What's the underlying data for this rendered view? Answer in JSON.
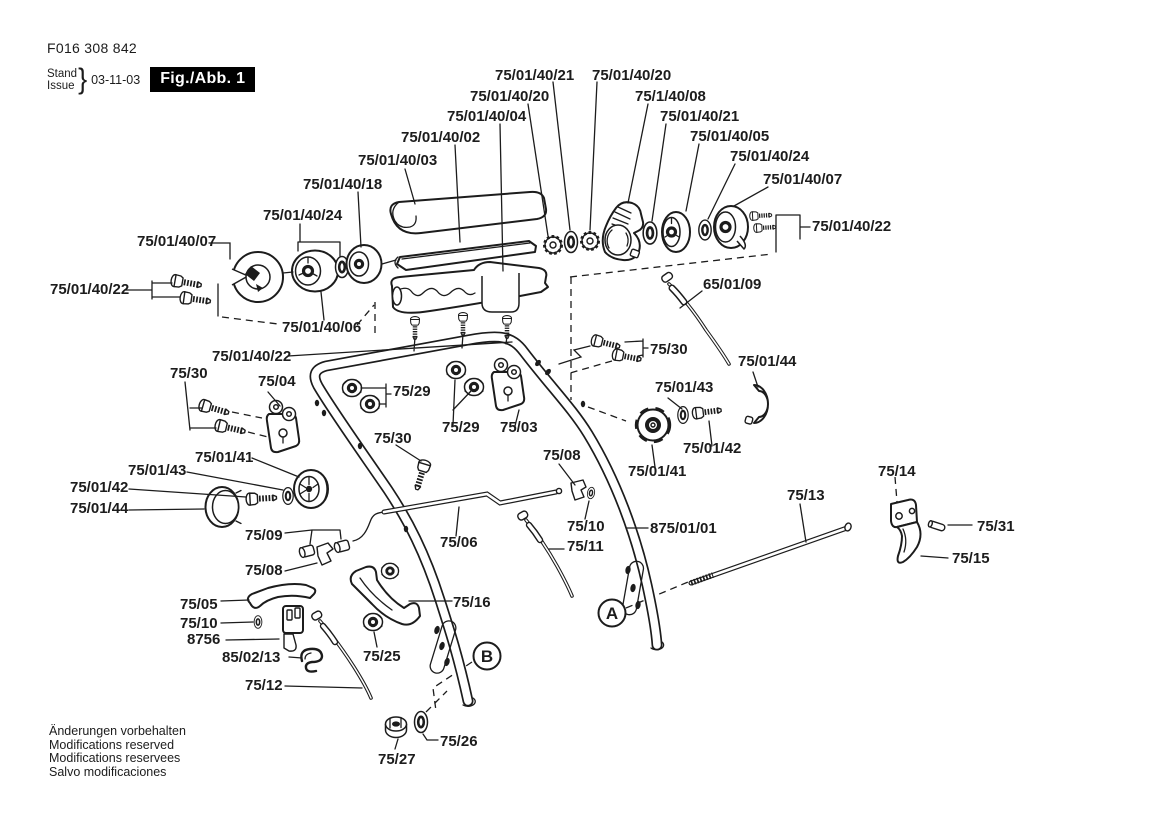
{
  "header": {
    "doc_number": "F016 308 842",
    "stand_label": "Stand",
    "issue_label": "Issue",
    "date": "03-11-03",
    "figure_label": "Fig./Abb. 1"
  },
  "footer": {
    "lines": [
      "Änderungen vorbehalten",
      "Modifications reserved",
      "Modifications reservees",
      "Salvo modificaciones"
    ]
  },
  "colors": {
    "ink": "#1c1c1c",
    "paper": "#ffffff"
  },
  "part_labels": [
    {
      "text": "75/01/40/21",
      "x": 495,
      "y": 80
    },
    {
      "text": "75/01/40/20",
      "x": 592,
      "y": 80
    },
    {
      "text": "75/01/40/20",
      "x": 470,
      "y": 101
    },
    {
      "text": "75/1/40/08",
      "x": 635,
      "y": 101
    },
    {
      "text": "75/01/40/04",
      "x": 447,
      "y": 121
    },
    {
      "text": "75/01/40/21",
      "x": 660,
      "y": 121
    },
    {
      "text": "75/01/40/02",
      "x": 401,
      "y": 142
    },
    {
      "text": "75/01/40/05",
      "x": 690,
      "y": 141
    },
    {
      "text": "75/01/40/03",
      "x": 358,
      "y": 165
    },
    {
      "text": "75/01/40/24",
      "x": 730,
      "y": 161
    },
    {
      "text": "75/01/40/18",
      "x": 303,
      "y": 189
    },
    {
      "text": "75/01/40/07",
      "x": 763,
      "y": 184
    },
    {
      "text": "75/01/40/24",
      "x": 263,
      "y": 220
    },
    {
      "text": "75/01/40/22",
      "x": 812,
      "y": 231
    },
    {
      "text": "75/01/40/07",
      "x": 137,
      "y": 246
    },
    {
      "text": "75/01/40/22",
      "x": 50,
      "y": 294
    },
    {
      "text": "65/01/09",
      "x": 703,
      "y": 289
    },
    {
      "text": "75/01/40/06",
      "x": 282,
      "y": 332
    },
    {
      "text": "75/01/40/22",
      "x": 212,
      "y": 361
    },
    {
      "text": "75/30",
      "x": 650,
      "y": 354
    },
    {
      "text": "75/01/44",
      "x": 738,
      "y": 366
    },
    {
      "text": "75/30",
      "x": 170,
      "y": 378
    },
    {
      "text": "75/04",
      "x": 258,
      "y": 386
    },
    {
      "text": "75/01/43",
      "x": 655,
      "y": 392
    },
    {
      "text": "75/29",
      "x": 393,
      "y": 396
    },
    {
      "text": "75/29",
      "x": 442,
      "y": 432
    },
    {
      "text": "75/03",
      "x": 500,
      "y": 432
    },
    {
      "text": "75/30",
      "x": 374,
      "y": 443
    },
    {
      "text": "75/01/42",
      "x": 683,
      "y": 453
    },
    {
      "text": "75/01/41",
      "x": 195,
      "y": 462
    },
    {
      "text": "75/08",
      "x": 543,
      "y": 460
    },
    {
      "text": "75/01/41",
      "x": 628,
      "y": 476
    },
    {
      "text": "75/14",
      "x": 878,
      "y": 476
    },
    {
      "text": "75/01/43",
      "x": 128,
      "y": 475
    },
    {
      "text": "75/01/42",
      "x": 70,
      "y": 492
    },
    {
      "text": "75/13",
      "x": 787,
      "y": 500
    },
    {
      "text": "75/01/44",
      "x": 70,
      "y": 513
    },
    {
      "text": "75/31",
      "x": 977,
      "y": 531
    },
    {
      "text": "75/09",
      "x": 245,
      "y": 540
    },
    {
      "text": "75/10",
      "x": 567,
      "y": 531
    },
    {
      "text": "875/01/01",
      "x": 650,
      "y": 533
    },
    {
      "text": "75/06",
      "x": 440,
      "y": 547
    },
    {
      "text": "75/11",
      "x": 567,
      "y": 551
    },
    {
      "text": "75/15",
      "x": 952,
      "y": 563
    },
    {
      "text": "75/08",
      "x": 245,
      "y": 575
    },
    {
      "text": "75/05",
      "x": 180,
      "y": 609
    },
    {
      "text": "75/16",
      "x": 453,
      "y": 607
    },
    {
      "text": "75/10",
      "x": 180,
      "y": 628
    },
    {
      "text": "8756",
      "x": 187,
      "y": 644
    },
    {
      "text": "85/02/13",
      "x": 222,
      "y": 662
    },
    {
      "text": "75/25",
      "x": 363,
      "y": 661
    },
    {
      "text": "75/12",
      "x": 245,
      "y": 690
    },
    {
      "text": "75/26",
      "x": 440,
      "y": 746
    },
    {
      "text": "75/27",
      "x": 378,
      "y": 764
    }
  ],
  "view_markers": [
    {
      "letter": "A",
      "x": 612,
      "y": 613
    },
    {
      "letter": "B",
      "x": 487,
      "y": 656
    }
  ]
}
